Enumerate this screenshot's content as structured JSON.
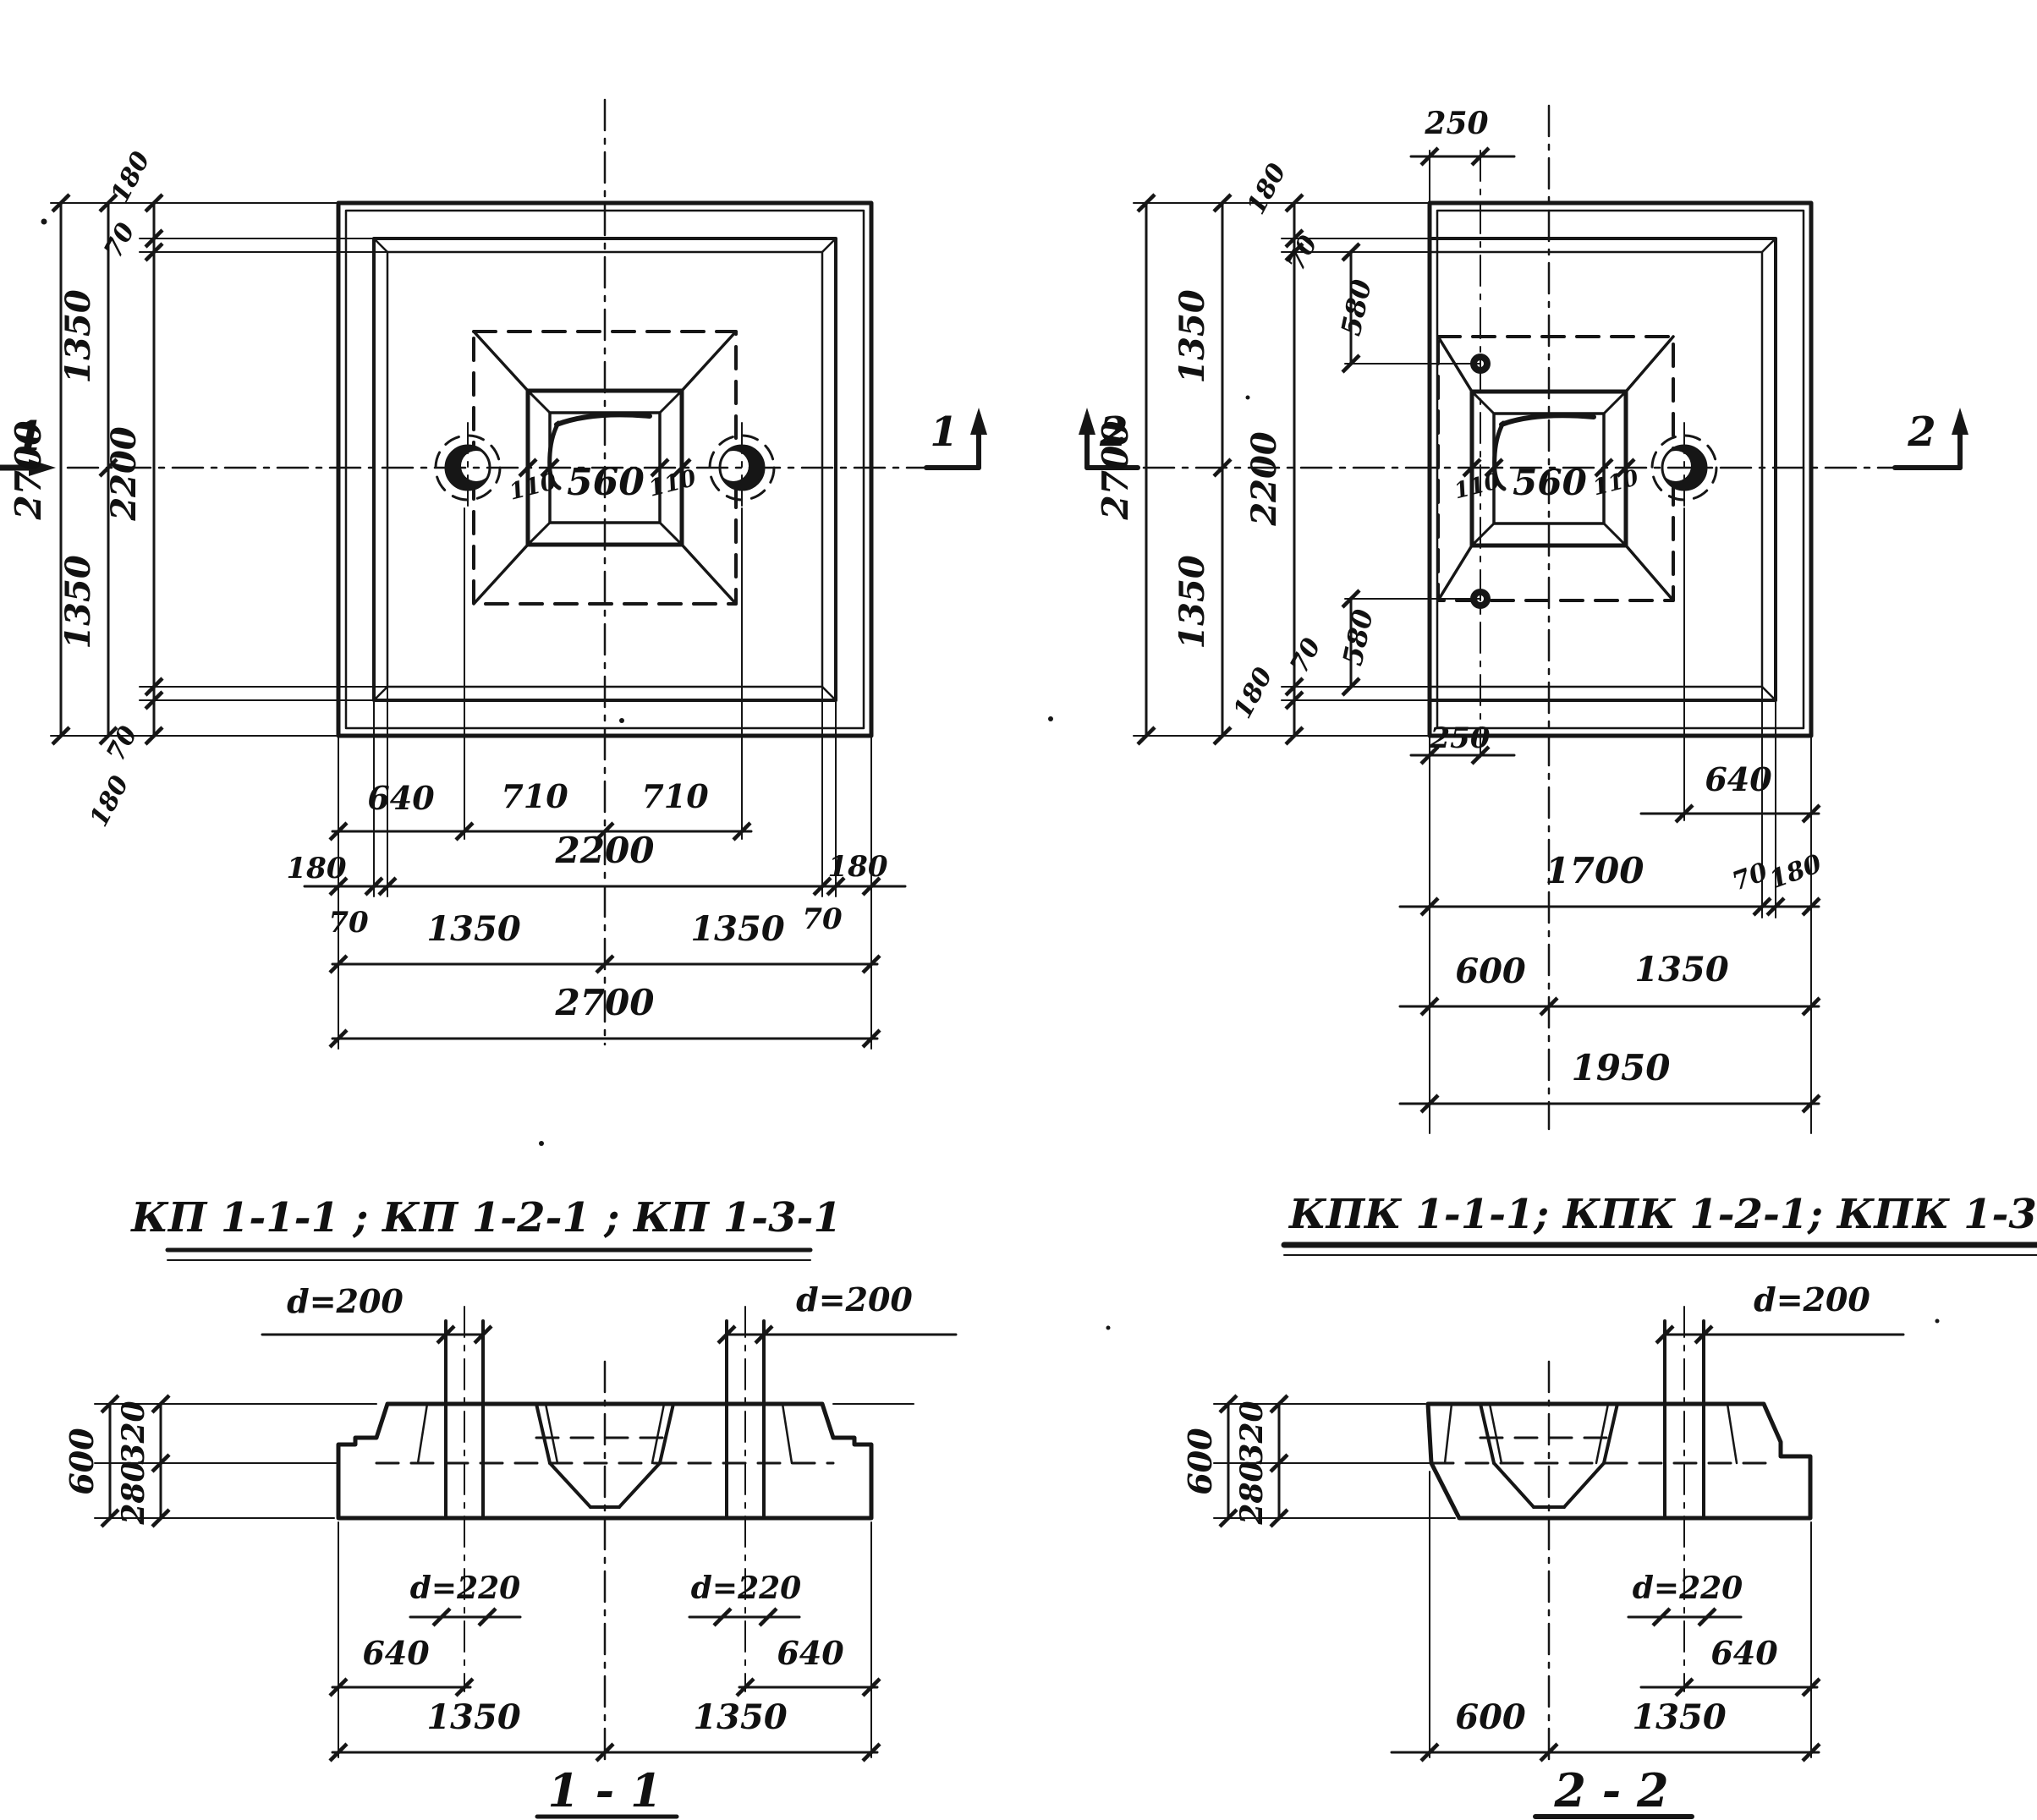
{
  "meta": {
    "background": "#ffffff",
    "ink": "#161616"
  },
  "plan_left": {
    "marker_left": "1",
    "marker_right": "1",
    "chains_left": {
      "d2700": "2700",
      "d1350_top": "1350",
      "d1350_bottom": "1350",
      "d2200": "2200",
      "d180_top": "180",
      "d70_top": "70",
      "d70_bottom": "70",
      "d180_bottom": "180"
    },
    "socket": {
      "d110_left": "110",
      "d560": "560",
      "d110_right": "110"
    },
    "chains_bottom": {
      "d640": "640",
      "d710_left": "710",
      "d710_right": "710",
      "d180_left": "180",
      "d2200": "2200",
      "d180_right": "180",
      "d70_left": "70",
      "d70_right": "70",
      "d1350_left": "1350",
      "d1350_right": "1350",
      "d2700": "2700"
    }
  },
  "plan_right": {
    "marker_left": "2",
    "marker_right": "2",
    "top": {
      "d250": "250"
    },
    "chains_left": {
      "d2700": "2700",
      "d1350_top": "1350",
      "d1350_bottom": "1350",
      "d2200": "2200",
      "d180_top": "180",
      "d70_top": "70",
      "d580_top": "580",
      "d70_bottom": "70",
      "d580_bottom": "580",
      "d180_bottom": "180",
      "d250_bottom": "250"
    },
    "socket": {
      "d110_left": "110",
      "d560": "560",
      "d110_right": "110"
    },
    "chains_bottom": {
      "d640": "640",
      "d1700": "1700",
      "d70": "70",
      "d180": "180",
      "d600": "600",
      "d1350": "1350",
      "d1950": "1950"
    }
  },
  "titles": {
    "left": "КП 1-1-1 ; КП 1-2-1 ; КП 1-3-1",
    "right": "КПК 1-1-1; КПК 1-2-1; КПК 1-3-1"
  },
  "section_1": {
    "d200_left": "d=200",
    "d200_right": "d=200",
    "d600": "600",
    "d320": "320",
    "d280": "280",
    "d220_left": "d=220",
    "d220_right": "d=220",
    "d640_left": "640",
    "d640_right": "640",
    "d1350_left": "1350",
    "d1350_right": "1350",
    "title": "1 - 1"
  },
  "section_2": {
    "d200": "d=200",
    "d600_left": "600",
    "d320": "320",
    "d280": "280",
    "d220": "d=220",
    "d640": "640",
    "d600_bottom": "600",
    "d1350": "1350",
    "title": "2 - 2"
  }
}
